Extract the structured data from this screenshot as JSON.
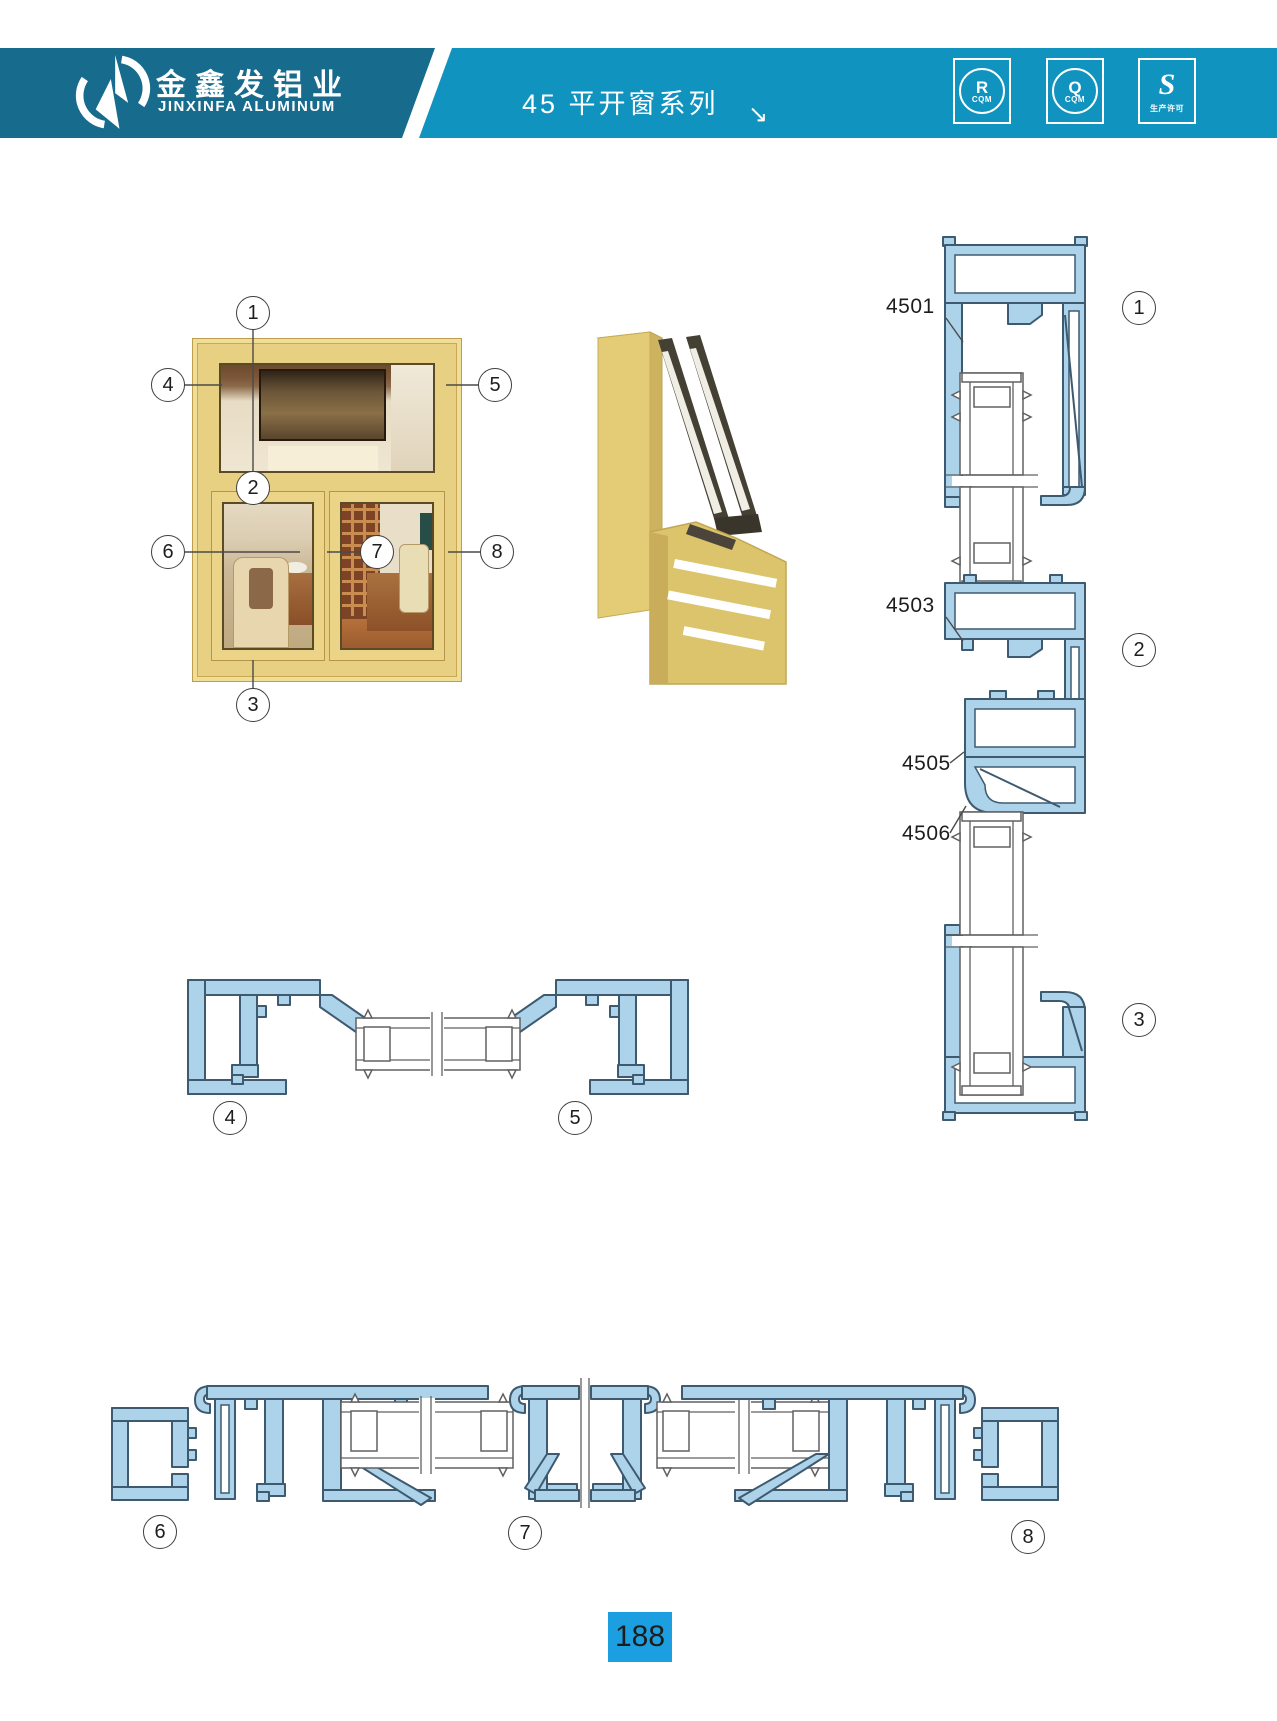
{
  "header": {
    "company_cn": "金鑫发铝业",
    "company_en": "JINXINFA ALUMINUM",
    "series_title": "45 平开窗系列",
    "arrow": "↘",
    "badges": [
      {
        "letter": "R",
        "sub": "CQM"
      },
      {
        "letter": "Q",
        "sub": "CQM"
      },
      {
        "letter": "S",
        "sub": "生产许可"
      }
    ]
  },
  "callouts": {
    "c1": "1",
    "c2": "2",
    "c3": "3",
    "c4": "4",
    "c5": "5",
    "c6": "6",
    "c7": "7",
    "c8": "8"
  },
  "profile_labels": {
    "p4501": "4501",
    "p4503": "4503",
    "p4505": "4505",
    "p4506": "4506"
  },
  "footer": {
    "page_number": "188"
  },
  "colors": {
    "band_left": "#176B8C",
    "band_right": "#1193BF",
    "page_num_bg": "#1C9FE0",
    "drawing_blue_fill": "#ACD3E9",
    "drawing_blue_stroke": "#3E5A70",
    "window_gold": "#E7D081"
  }
}
